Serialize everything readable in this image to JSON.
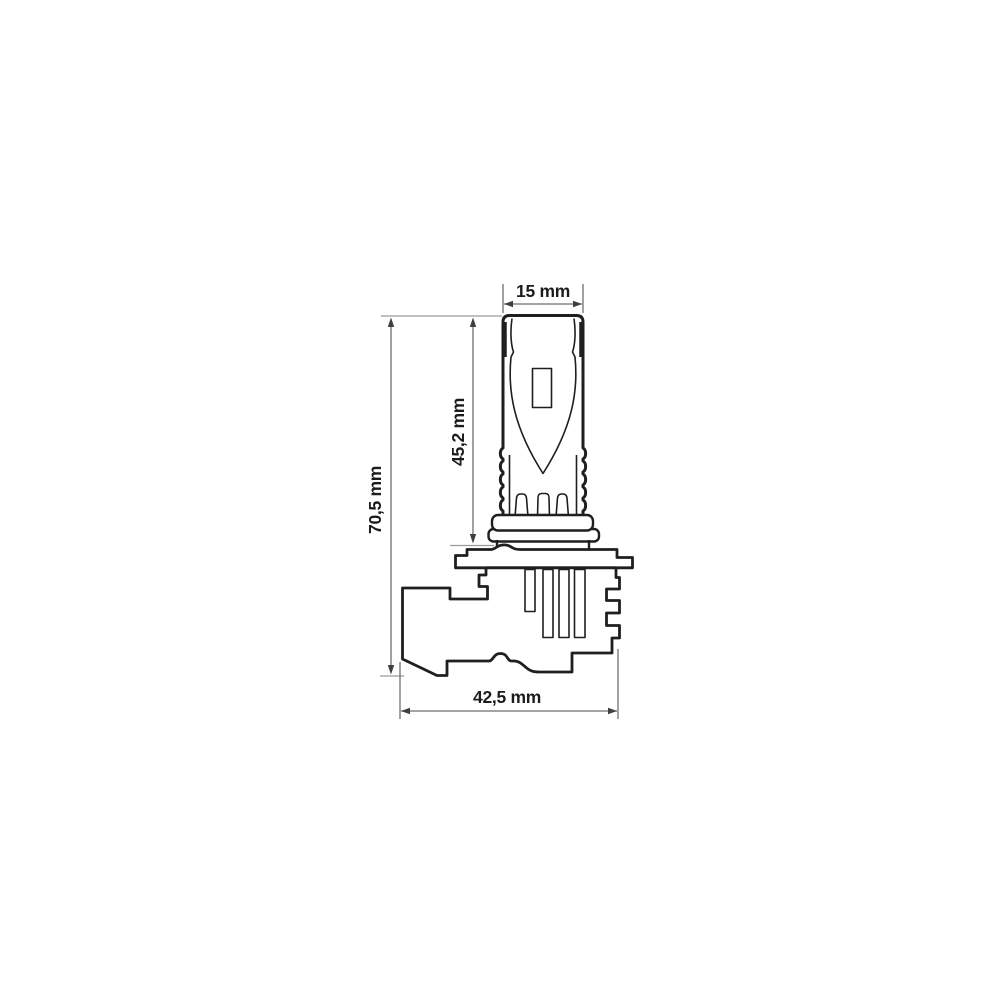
{
  "diagram": {
    "background": "#ffffff",
    "outline_color": "#1f1f1f",
    "detail_color": "#2a2a2a",
    "dimension_line_color": "#6f6f6f",
    "extension_line_color": "#9a9a9a",
    "arrow_color": "#3f3f3f",
    "label_color": "#1c1c1c",
    "unit": "mm",
    "dimensions": {
      "top_width": {
        "label": "15 mm",
        "value_mm": 15
      },
      "upper_height": {
        "label": "45,2 mm",
        "value_mm": 45.2
      },
      "total_height": {
        "label": "70,5 mm",
        "value_mm": 70.5
      },
      "base_width": {
        "label": "42,5 mm",
        "value_mm": 42.5
      }
    }
  }
}
